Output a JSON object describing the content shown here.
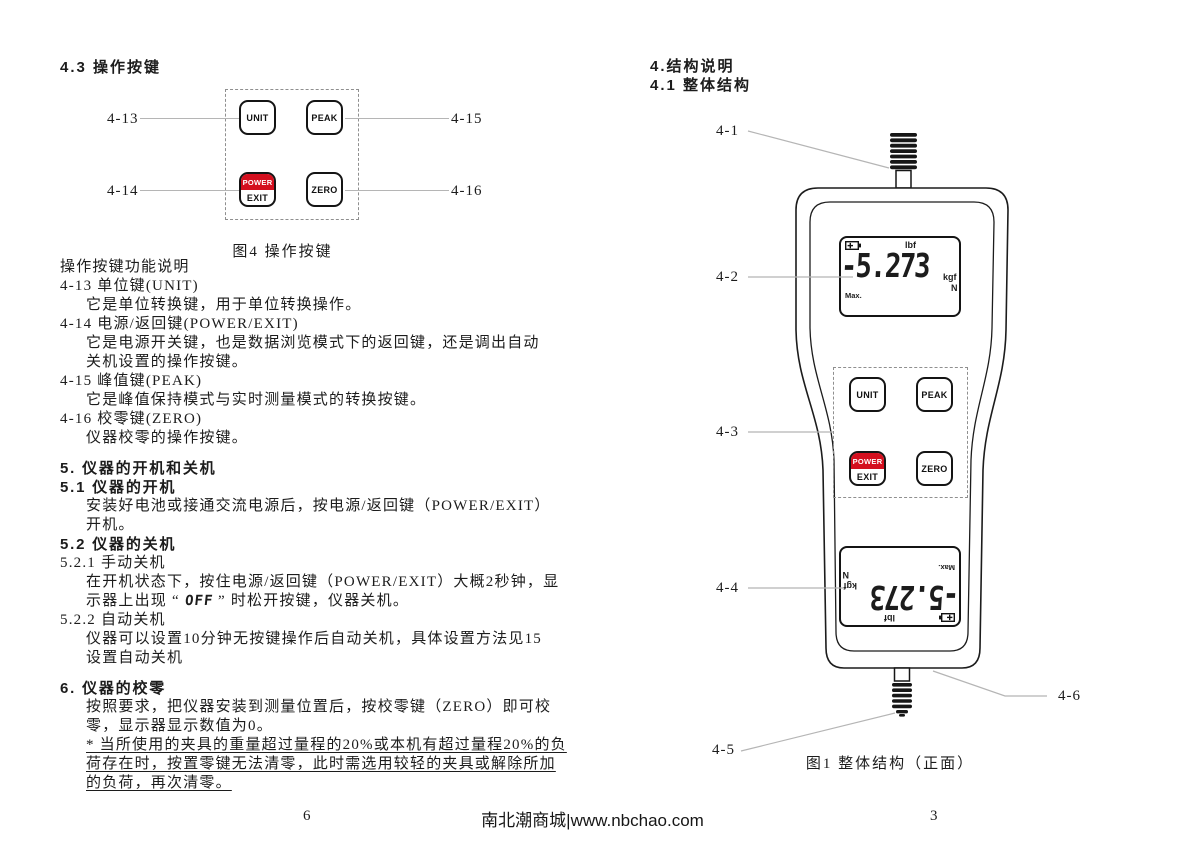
{
  "doc": {
    "left_page": {
      "title": "4.3 操作按键",
      "figure4": {
        "caption": "图4 操作按键",
        "labels": {
          "k13": "4-13",
          "k14": "4-14",
          "k15": "4-15",
          "k16": "4-16"
        }
      },
      "body": {
        "func_intro": "操作按键功能说明",
        "item13_head": "4-13 单位键(UNIT)",
        "item13_body": "它是单位转换键，用于单位转换操作。",
        "item14_head": "4-14 电源/返回键(POWER/EXIT)",
        "item14_body1": "它是电源开关键，也是数据浏览模式下的返回键，还是调出自动",
        "item14_body2": "关机设置的操作按键。",
        "item15_head": "4-15 峰值键(PEAK)",
        "item15_body": "它是峰值保持模式与实时测量模式的转换按键。",
        "item16_head": "4-16 校零键(ZERO)",
        "item16_body": "仪器校零的操作按键。",
        "sec5_title": "5. 仪器的开机和关机",
        "sec51_title": "5.1 仪器的开机",
        "sec51_body1": "安装好电池或接通交流电源后，按电源/返回键（POWER/EXIT）",
        "sec51_body2": "开机。",
        "sec52_title": "5.2 仪器的关机",
        "sec521_title": "5.2.1 手动关机",
        "sec521_body1": "在开机状态下，按住电源/返回键（POWER/EXIT）大概2秒钟，显",
        "sec521_pre": "示器上出现 “ ",
        "sec521_lcd": "OFF",
        "sec521_post": " ” 时松开按键，仪器关机。",
        "sec522_title": "5.2.2 自动关机",
        "sec522_body1": "仪器可以设置10分钟无按键操作后自动关机，具体设置方法见15",
        "sec522_body2": "设置自动关机",
        "sec6_title": "6. 仪器的校零",
        "sec6_body1": "按照要求，把仪器安装到测量位置后，按校零键（ZERO）即可校",
        "sec6_body2": "零，显示器显示数值为0。",
        "sec6_note1": "* 当所使用的夹具的重量超过量程的20%或本机有超过量程20%的负",
        "sec6_note2": "荷存在时，按置零键无法清零，此时需选用较轻的夹具或解除所加",
        "sec6_note3": "的负荷，再次清零。"
      }
    },
    "right_page": {
      "sec4_title": "4.结构说明",
      "sec41_title": "4.1 整体结构",
      "figure1": {
        "caption": "图1 整体结构（正面）",
        "labels": {
          "k1": "4-1",
          "k2": "4-2",
          "k3": "4-3",
          "k4": "4-4",
          "k5": "4-5",
          "k6": "4-6"
        }
      }
    },
    "keypad": {
      "unit": "UNIT",
      "peak": "PEAK",
      "power": "POWER",
      "exit": "EXIT",
      "zero": "ZERO"
    },
    "lcd": {
      "unit_top": "lbf",
      "value": "-5.273",
      "unit_right1": "kgf",
      "unit_right2": "N",
      "max_label": "Max."
    },
    "icons": {
      "battery_status": "battery-icon"
    },
    "footer": {
      "page_left": "6",
      "center": "南北潮商城|www.nbchao.com",
      "page_right": "3"
    },
    "colors": {
      "accent_red": "#d40f1e",
      "leader_line": "#b5b5b5",
      "ink": "#1c1c1c"
    }
  }
}
